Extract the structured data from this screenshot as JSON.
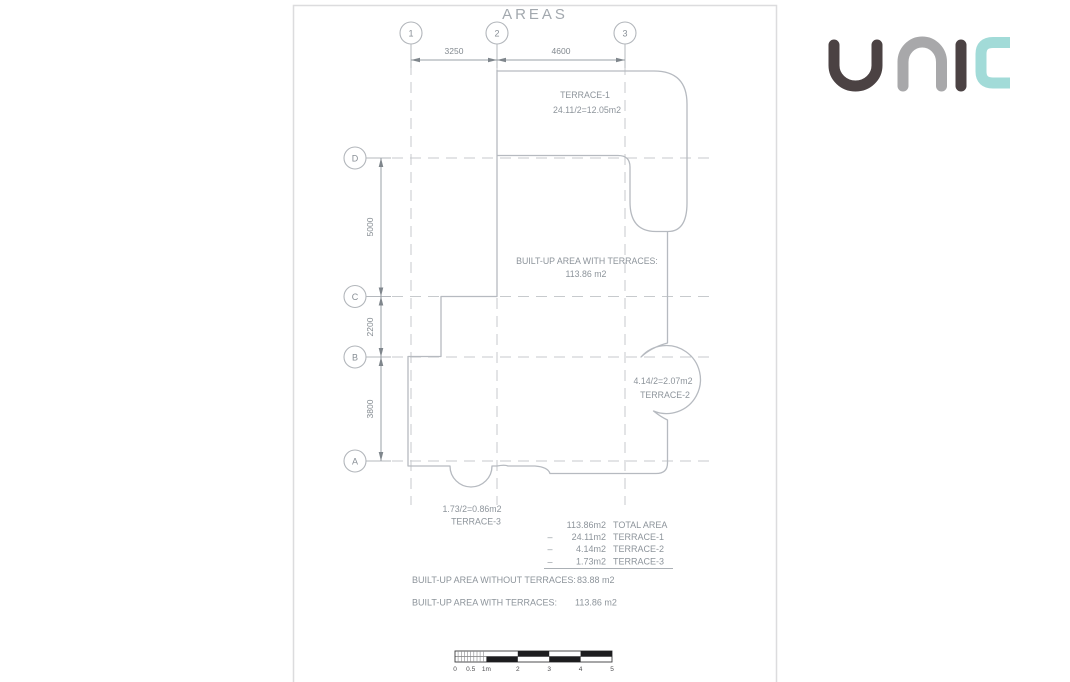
{
  "title": "AREAS",
  "logo": {
    "text": "unic",
    "letters": [
      "u",
      "n",
      "i",
      "c"
    ],
    "colors": {
      "u": "#4b4243",
      "n": "#a8a8aa",
      "i": "#4b4243",
      "c": "#a2dbd8"
    }
  },
  "grid": {
    "columns": [
      "1",
      "2",
      "3"
    ],
    "rows": [
      "D",
      "C",
      "B",
      "A"
    ],
    "column_dims": [
      "3250",
      "4600"
    ],
    "row_dims": [
      "5000",
      "2200",
      "3800"
    ]
  },
  "terraces": [
    {
      "name": "TERRACE-1",
      "formula": "24.11/2=12.05m2"
    },
    {
      "name": "TERRACE-2",
      "formula": "4.14/2=2.07m2"
    },
    {
      "name": "TERRACE-3",
      "formula": "1.73/2=0.86m2"
    }
  ],
  "builtup": {
    "line1": "BUILT-UP AREA WITH TERRACES:",
    "line2": "113.86 m2"
  },
  "summary": {
    "rows": [
      {
        "sign": "",
        "value": "113.86m2",
        "label": "TOTAL AREA"
      },
      {
        "sign": "–",
        "value": "24.11m2",
        "label": "TERRACE-1"
      },
      {
        "sign": "–",
        "value": "4.14m2",
        "label": "TERRACE-2"
      },
      {
        "sign": "–",
        "value": "1.73m2",
        "label": "TERRACE-3"
      }
    ]
  },
  "totals": [
    {
      "label": "BUILT-UP AREA WITHOUT TERRACES:",
      "value": "83.88 m2"
    },
    {
      "label": "BUILT-UP AREA WITH TERRACES:",
      "value": "113.86 m2"
    }
  ],
  "scale": {
    "labels": [
      "0",
      "0.5",
      "1m",
      "2",
      "3",
      "4",
      "5"
    ]
  },
  "colors": {
    "wall_line": "#b6bac0",
    "grid_line": "#c7cacd",
    "annotation_text": "#8d949b",
    "title_text": "#a2a8ae",
    "scale_black": "#1d1d1f",
    "sheet_border": "#dcdcde"
  }
}
